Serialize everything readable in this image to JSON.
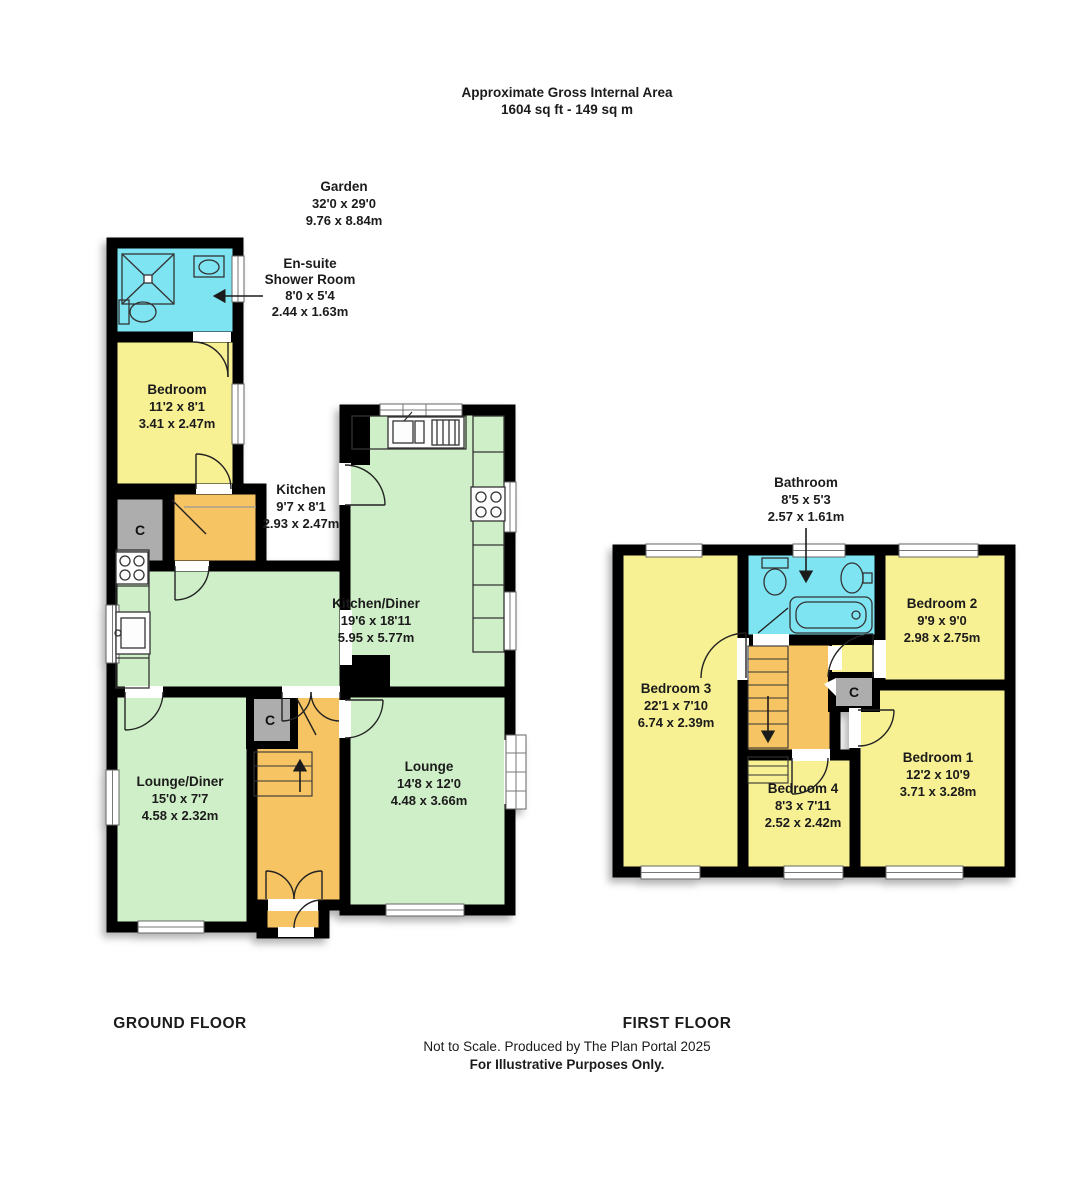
{
  "header": {
    "title_line1": "Approximate Gross Internal Area",
    "title_line2": "1604 sq ft - 149 sq m"
  },
  "garden": {
    "name": "Garden",
    "imperial": "32'0 x 29'0",
    "metric": "9.76 x 8.84m"
  },
  "ground": {
    "floor_label": "GROUND FLOOR",
    "cupboard": "C",
    "ensuite": {
      "name_line1": "En-suite",
      "name_line2": "Shower Room",
      "imperial": "8'0 x 5'4",
      "metric": "2.44 x 1.63m"
    },
    "bedroom": {
      "name": "Bedroom",
      "imperial": "11'2 x 8'1",
      "metric": "3.41 x 2.47m"
    },
    "kitchen": {
      "name": "Kitchen",
      "imperial": "9'7 x 8'1",
      "metric": "2.93 x 2.47m"
    },
    "kitchen_diner": {
      "name": "Kitchen/Diner",
      "imperial": "19'6 x 18'11",
      "metric": "5.95 x 5.77m"
    },
    "lounge_diner": {
      "name": "Lounge/Diner",
      "imperial": "15'0 x 7'7",
      "metric": "4.58 x 2.32m"
    },
    "lounge": {
      "name": "Lounge",
      "imperial": "14'8 x 12'0",
      "metric": "4.48 x 3.66m"
    }
  },
  "first": {
    "floor_label": "FIRST FLOOR",
    "cupboard": "C",
    "bathroom": {
      "name": "Bathroom",
      "imperial": "8'5 x 5'3",
      "metric": "2.57 x 1.61m"
    },
    "bedroom2": {
      "name": "Bedroom 2",
      "imperial": "9'9 x 9'0",
      "metric": "2.98 x 2.75m"
    },
    "bedroom3": {
      "name": "Bedroom 3",
      "imperial": "22'1 x 7'10",
      "metric": "6.74 x 2.39m"
    },
    "bedroom1": {
      "name": "Bedroom 1",
      "imperial": "12'2 x 10'9",
      "metric": "3.71 x 3.28m"
    },
    "bedroom4": {
      "name": "Bedroom 4",
      "imperial": "8'3 x 7'11",
      "metric": "2.52 x 2.42m"
    }
  },
  "footer": {
    "line1": "Not to Scale. Produced by The Plan Portal 2025",
    "line2": "For Illustrative Purposes Only."
  },
  "icons": [
    "shower-tray-icon",
    "toilet-icon",
    "basin-icon",
    "bath-icon",
    "hob-icon",
    "sink-unit-icon",
    "stairs-icon",
    "door-arc-icon",
    "window-icon"
  ],
  "colors": {
    "wall": "#000000",
    "bedroom_yellow": "#F8F194",
    "living_green": "#CFEFC8",
    "bathroom_cyan": "#7FE4F2",
    "hall_orange": "#F7C464",
    "cupboard_gray": "#ADADAD"
  }
}
